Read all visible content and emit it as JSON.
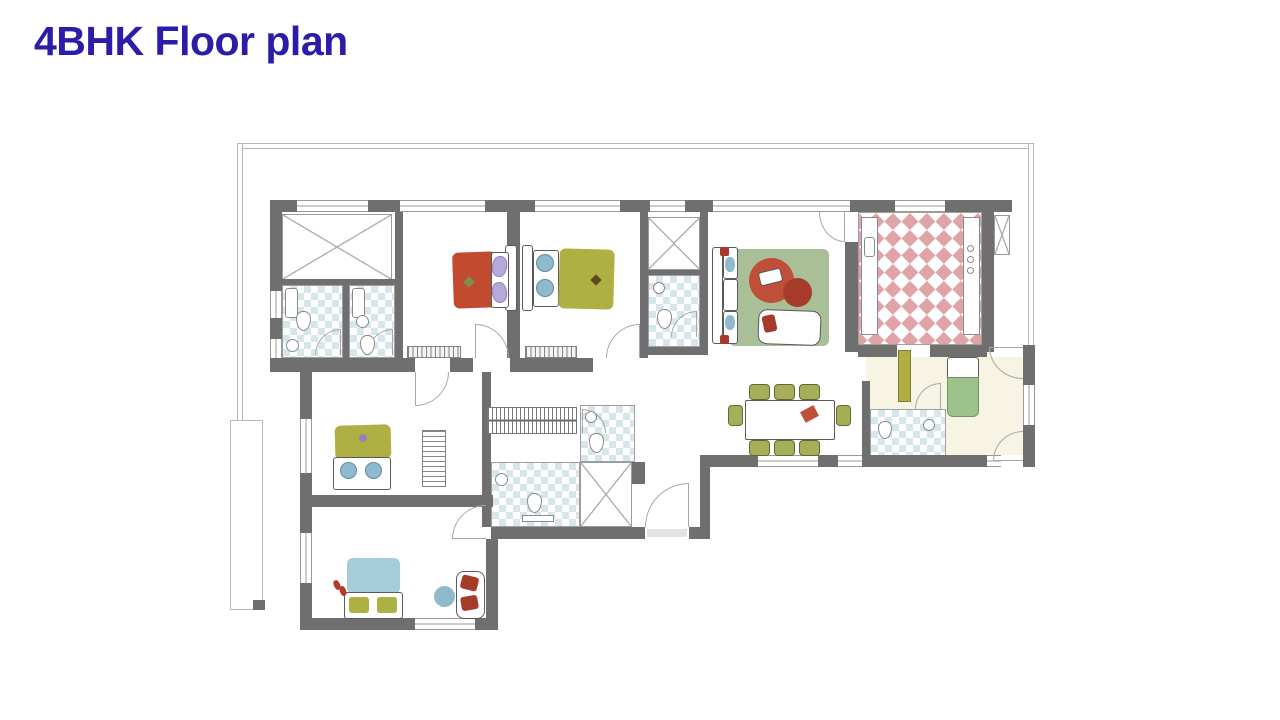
{
  "title": "4BHK Floor plan",
  "palette": {
    "title": "#2b1da8",
    "wall": "#6f6f6f",
    "line": "#9a9a9a",
    "tile_blue": "#d7e6ea",
    "tile_pink": "#e0a4a8",
    "rug": "#a9bf98",
    "table_red": "#bf4f38",
    "table_red_dark": "#a53b28",
    "bed_red": "#c14a31",
    "pillow_lavender": "#b4a9d9",
    "olive": "#aeb044",
    "bed_blue": "#a8cdda",
    "pillow_blue": "#8fb9cc",
    "maid_green": "#9cc28e",
    "cream": "#f7f4e4",
    "chair_olive": "#a6ae58"
  }
}
